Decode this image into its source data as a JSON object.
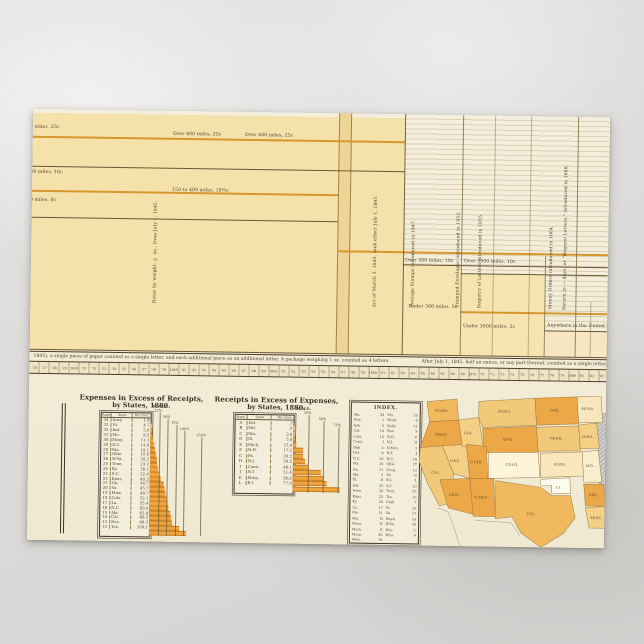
{
  "card": {
    "type": "postcard photograph of statistical atlas plate"
  },
  "timeline": {
    "labels": [
      {
        "x": -22,
        "y": 16,
        "t": "Over 400 miles, 25c"
      },
      {
        "x": -22,
        "y": 61,
        "t": "150 to 400 miles, 10c"
      },
      {
        "x": -22,
        "y": 89,
        "t": "80 to 150 miles, 6c"
      },
      {
        "x": 140,
        "y": 21,
        "t": "Over 400 miles, 25c"
      },
      {
        "x": 212,
        "y": 21,
        "t": "Over 400 miles, 25c"
      },
      {
        "x": 140,
        "y": 77,
        "t": "150 to 400 miles, 18¾c"
      },
      {
        "x": 374,
        "y": 144,
        "t": "Over 300 miles, 10c"
      },
      {
        "x": 433,
        "y": 144,
        "t": "Over 3000 miles, 10c"
      },
      {
        "x": 378,
        "y": 190,
        "t": "Under 300 miles, 5c"
      },
      {
        "x": 433,
        "y": 209,
        "t": "Under 3000 miles, 3c"
      },
      {
        "x": 517,
        "y": 207,
        "t": "Anywhere in the United States, 3c"
      }
    ],
    "vlabels": [
      {
        "x": 122,
        "t": "Rates by weight, ½ oz., from July 1, 1845."
      },
      {
        "x": 342,
        "t": "Act of March 3, 1845, took effect July 1, 1845."
      },
      {
        "x": 380,
        "t": "Postage Stamps introduced in 1847."
      },
      {
        "x": 425,
        "t": "Stamped Envelopes introduced in 1852."
      },
      {
        "x": 447,
        "t": "Registry of Letters introduced in 1855."
      },
      {
        "x": 518,
        "t": "Money Orders introduced in 1864."
      },
      {
        "x": 532,
        "t": "Return in — days, or \"Request Letters,\" introduced in 1868."
      }
    ],
    "caption_left": "1845), a single piece of paper counted as a single letter, and each additional piece as an additional letter.   A package weighing 1 oz. counted as 4 letters.",
    "caption_right": "After July 1, 1845, half an ounce, or any part thereof, counted as a single letter.",
    "year_ticks": [
      "'26",
      "'27",
      "'28",
      "'29",
      "1830",
      "'31",
      "'32",
      "'33",
      "'34",
      "'35",
      "'36",
      "'37",
      "'38",
      "'39",
      "1840",
      "'41",
      "'42",
      "'43",
      "'44",
      "'45",
      "'46",
      "'47",
      "'48",
      "'49",
      "1850",
      "'51",
      "'52",
      "'53",
      "'54",
      "'55",
      "'56",
      "'57",
      "'58",
      "'59",
      "1860",
      "'61",
      "'62",
      "'63",
      "'64",
      "'65",
      "'66",
      "'67",
      "'68",
      "'69",
      "1870",
      "'71",
      "'72",
      "'73",
      "'74",
      "'75",
      "'76",
      "'77",
      "'78",
      "'79",
      "1880",
      "'81",
      "'82",
      "'83"
    ]
  },
  "chart_data": [
    {
      "type": "bar",
      "title": "Expenses in Excess of Receipts,",
      "subtitle": "by States, 1880.",
      "columns": [
        "Rank",
        "State",
        "Per Cent."
      ],
      "scale_heading": "SCALE:",
      "scale_labels": [
        "25%",
        "50%",
        "75%",
        "100%",
        "150%"
      ],
      "scale_pcts": [
        25,
        50,
        75,
        100,
        150
      ],
      "bar_color": "#f0a43e",
      "rows": [
        [
          "34",
          "Iowa",
          "1.8"
        ],
        [
          "33",
          "Vt.",
          "4.7"
        ],
        [
          "32",
          "Ind.",
          "5.6"
        ],
        [
          "31",
          "Me.",
          "8.5"
        ],
        [
          "30",
          "Minn.",
          "11.1"
        ],
        [
          "29",
          "D.C.",
          "14.0"
        ],
        [
          "28",
          "Mo.",
          "18.1"
        ],
        [
          "27",
          "Ohio",
          "19.9"
        ],
        [
          "26",
          "W.Va.",
          "20.2"
        ],
        [
          "25",
          "Tenn.",
          "23.2"
        ],
        [
          "24",
          "Ky.",
          "26.1"
        ],
        [
          "23",
          "S.C.",
          "32.4"
        ],
        [
          "22",
          "Kans.",
          "40.3"
        ],
        [
          "21",
          "Ga.",
          "44.7"
        ],
        [
          "20",
          "Va.",
          "45.7"
        ],
        [
          "19",
          "Miss.",
          "48.7"
        ],
        [
          "18",
          "Colo.",
          "52.1"
        ],
        [
          "17",
          "La.",
          "55.4"
        ],
        [
          "16",
          "N.C.",
          "60.4"
        ],
        [
          "15",
          "Ala.",
          "63.8"
        ],
        [
          "14",
          "Cal.",
          "68.3"
        ],
        [
          "13",
          "Nev.",
          "88.3"
        ],
        [
          "12",
          "Tex.",
          "109.1"
        ]
      ]
    },
    {
      "type": "bar",
      "title": "Receipts in Excess of Expenses,",
      "subtitle": "by States, 1880.",
      "columns": [
        "Rank",
        "State",
        "Per Cent."
      ],
      "scale_heading": "SCALE:",
      "scale_labels": [
        "25%",
        "50%",
        "75%",
        "100%"
      ],
      "scale_pcts": [
        25,
        50,
        75,
        100
      ],
      "bar_color": "#f0a43e",
      "rows": [
        [
          "A",
          "Del.",
          ".7"
        ],
        [
          "B",
          "Md.",
          ".9"
        ],
        [
          "C",
          "Wis.",
          "3.8"
        ],
        [
          "D",
          "Ill.",
          "5.8"
        ],
        [
          "E",
          "Mich.",
          "15.9"
        ],
        [
          "F",
          "N.H.",
          "17.2"
        ],
        [
          "G",
          "Pa.",
          "20.2"
        ],
        [
          "H",
          "N.J.",
          "24.5"
        ],
        [
          "I",
          "Conn.",
          "46.1"
        ],
        [
          "J",
          "N.Y.",
          "51.4"
        ],
        [
          "K",
          "Mass.",
          "56.8"
        ],
        [
          "L",
          "R.I.",
          "77.9"
        ]
      ]
    }
  ],
  "index": {
    "title": "INDEX.",
    "left_col": [
      [
        "Ala.",
        "20"
      ],
      [
        "Ariz.",
        "1"
      ],
      [
        "Ark.",
        "5"
      ],
      [
        "Cal.",
        "14"
      ],
      [
        "Colo.",
        "18"
      ],
      [
        "Conn.",
        "I"
      ],
      [
        "Dak.",
        "3"
      ],
      [
        "Del.",
        "A"
      ],
      [
        "D.C.",
        "29"
      ],
      [
        "Fla.",
        "26"
      ],
      [
        "Ga.",
        "21"
      ],
      [
        "Ida.",
        "2"
      ],
      [
        "Ill.",
        "D"
      ],
      [
        "Ind.",
        "32"
      ],
      [
        "Iowa",
        "34"
      ],
      [
        "Kans.",
        "22"
      ],
      [
        "Ky.",
        "24"
      ],
      [
        "La.",
        "17"
      ],
      [
        "Me.",
        "31"
      ],
      [
        "Md.",
        "B"
      ],
      [
        "Mass.",
        "K"
      ],
      [
        "Mich.",
        "E"
      ],
      [
        "Minn.",
        "30"
      ],
      [
        "Miss.",
        "19"
      ]
    ],
    "right_col": [
      [
        "Mo.",
        "28"
      ],
      [
        "Mont.",
        "8"
      ],
      [
        "Nebr.",
        "11"
      ],
      [
        "Nev.",
        "9"
      ],
      [
        "N.H.",
        "F"
      ],
      [
        "N.J.",
        "H"
      ],
      [
        "N.Mex.",
        "2"
      ],
      [
        "N.Y.",
        "J"
      ],
      [
        "N.C.",
        "16"
      ],
      [
        "Ohio",
        "27"
      ],
      [
        "Oreg.",
        "12"
      ],
      [
        "Pa.",
        "G"
      ],
      [
        "R.I.",
        "L"
      ],
      [
        "S.C.",
        "23"
      ],
      [
        "Tenn.",
        "25"
      ],
      [
        "Tex.",
        "13"
      ],
      [
        "Utah",
        "7"
      ],
      [
        "Vt.",
        "33"
      ],
      [
        "Va.",
        "21"
      ],
      [
        "Wash.",
        "10"
      ],
      [
        "W.Va.",
        "26"
      ],
      [
        "Wis.",
        "C"
      ],
      [
        "Wyo.",
        "4"
      ]
    ]
  },
  "map": {
    "hatch_color": "#8f8f8d",
    "states": [
      {
        "abbr": "WASH.",
        "fill": "#f0b95e",
        "lx": 25,
        "ly": 18
      },
      {
        "abbr": "OREG.",
        "fill": "#eca747",
        "lx": 25,
        "ly": 42
      },
      {
        "abbr": "CAL.",
        "fill": "#f2c979",
        "lx": 20,
        "ly": 80
      },
      {
        "abbr": "NEV.",
        "fill": "#f4cf86",
        "lx": 39,
        "ly": 68
      },
      {
        "abbr": "IDA.",
        "fill": "#f4cf86",
        "lx": 52,
        "ly": 40
      },
      {
        "abbr": "MONT.",
        "fill": "#f2c979",
        "lx": 88,
        "ly": 18
      },
      {
        "abbr": "WYO.",
        "fill": "#eca747",
        "lx": 92,
        "ly": 46
      },
      {
        "abbr": "UTAH",
        "fill": "#eca747",
        "lx": 60,
        "ly": 69
      },
      {
        "abbr": "COLO.",
        "fill": "#fdf4da",
        "lx": 96,
        "ly": 71
      },
      {
        "abbr": "ARIZ.",
        "fill": "#eca747",
        "lx": 39,
        "ly": 102
      },
      {
        "abbr": "N.MEX.",
        "fill": "#eca747",
        "lx": 66,
        "ly": 104
      },
      {
        "abbr": "DAK.",
        "fill": "#eca747",
        "lx": 138,
        "ly": 16
      },
      {
        "abbr": "MINN.",
        "fill": "#f8e7bc",
        "lx": 171,
        "ly": 14
      },
      {
        "abbr": "IOWA",
        "fill": "#f4cf86",
        "lx": 171,
        "ly": 42
      },
      {
        "abbr": "NEBR.",
        "fill": "#f2c979",
        "lx": 140,
        "ly": 44
      },
      {
        "abbr": "KANS.",
        "fill": "#f8e7bc",
        "lx": 144,
        "ly": 70
      },
      {
        "abbr": "MO.",
        "fill": "#f8edcc",
        "lx": 174,
        "ly": 71
      },
      {
        "abbr": "I.T.",
        "fill": "#fdfaee",
        "lx": 143,
        "ly": 93
      },
      {
        "abbr": "ARK.",
        "fill": "#eca747",
        "lx": 178,
        "ly": 100
      },
      {
        "abbr": "TEX.",
        "fill": "#f0b95e",
        "lx": 116,
        "ly": 120
      },
      {
        "abbr": "MISS.",
        "fill": "#f4cf86",
        "lx": 181,
        "ly": 123
      }
    ]
  }
}
